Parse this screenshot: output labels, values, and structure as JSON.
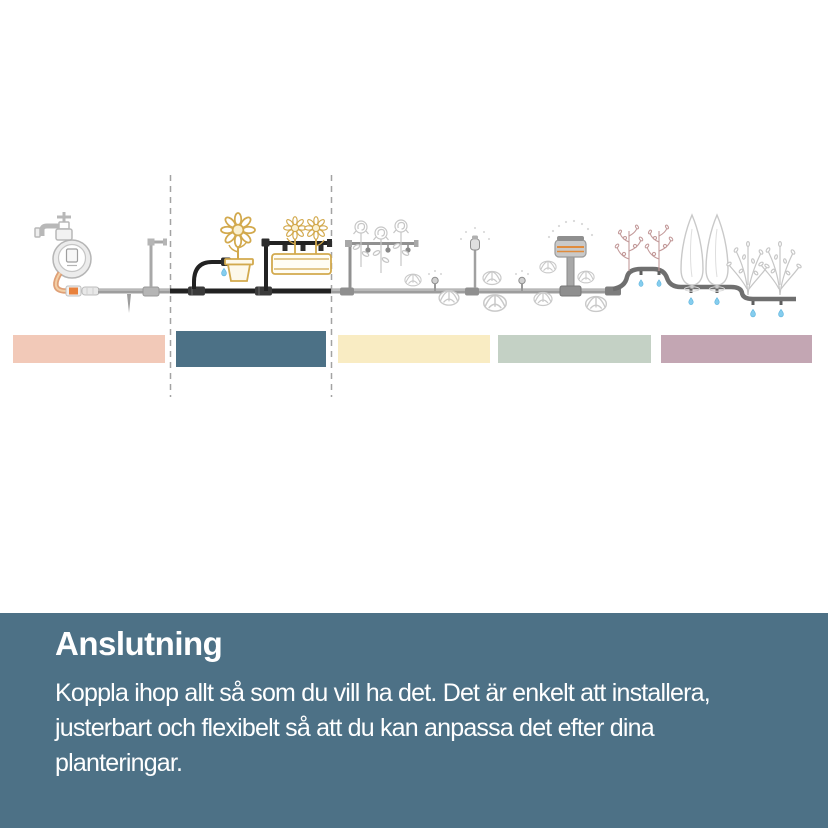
{
  "footer": {
    "title": "Anslutning",
    "body": "Koppla ihop allt så som du vill ha det. Det är enkelt att installera,\njusterbart och flexibelt så att du kan anpassa det efter dina\nplanteringar.",
    "background": "#4d7186",
    "text_color": "#ffffff"
  },
  "sections": [
    {
      "color": "#f2c9b8",
      "highlighted": false
    },
    {
      "color": "#4c7186",
      "highlighted": true
    },
    {
      "color": "#f9ecc3",
      "highlighted": false
    },
    {
      "color": "#c4d1c5",
      "highlighted": false
    },
    {
      "color": "#c3a6b3",
      "highlighted": false
    }
  ],
  "colors": {
    "accent_orange": "#e8813c",
    "pipe_gray": "#9d9d9d",
    "highlight_pipe_black": "#222222",
    "art_yellow": "#d2a94d",
    "art_rose_pink": "#c39a9a",
    "art_light_gray": "#c9c9c9",
    "water_drop_blue": "#85cdee",
    "divider_dash_gray": "#a3a3a3"
  }
}
